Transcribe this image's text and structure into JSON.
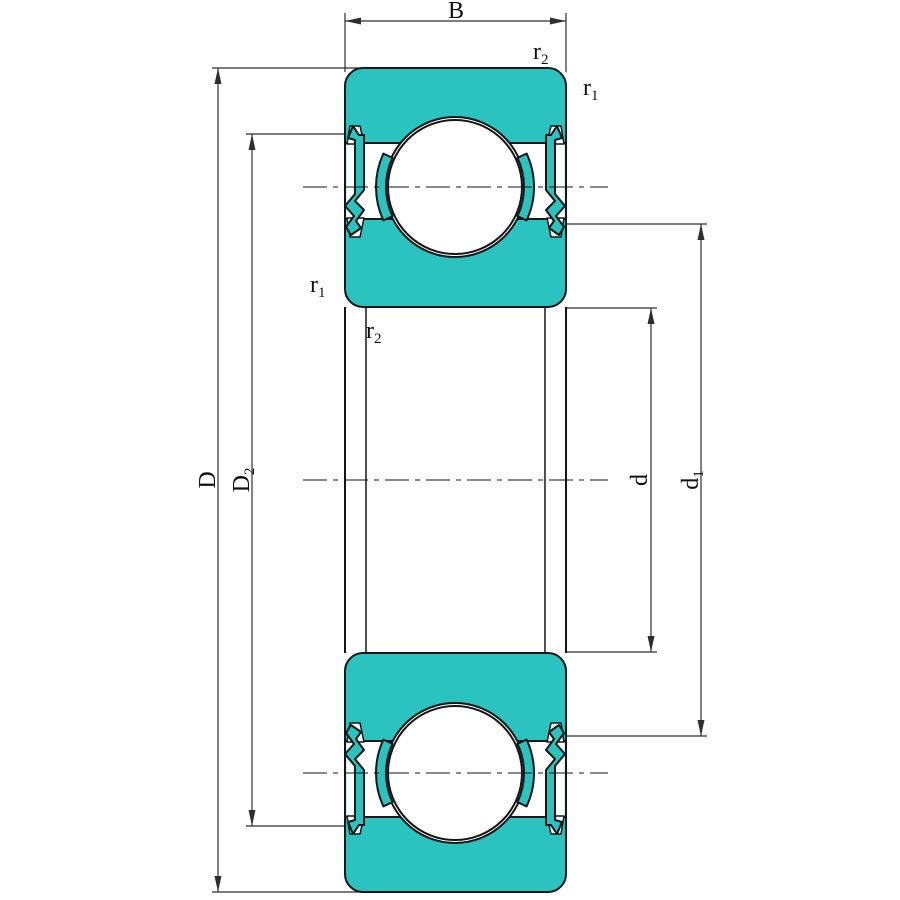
{
  "colors": {
    "bearing_fill": "#2BC3BF",
    "outline": "#161616",
    "dimension_line": "#2e2e2e",
    "background": "#ffffff"
  },
  "labels": {
    "width": {
      "base": "B"
    },
    "r2_outer": {
      "base": "r",
      "sub": "2"
    },
    "r1_outer": {
      "base": "r",
      "sub": "1"
    },
    "r1_inner": {
      "base": "r",
      "sub": "1"
    },
    "r2_bore": {
      "base": "r",
      "sub": "2"
    },
    "outer_diameter": {
      "base": "D"
    },
    "outer_shoulder_diameter": {
      "base": "D",
      "sub": "2"
    },
    "bore_diameter": {
      "base": "d"
    },
    "inner_shoulder_diameter": {
      "base": "d",
      "sub": "1"
    }
  }
}
